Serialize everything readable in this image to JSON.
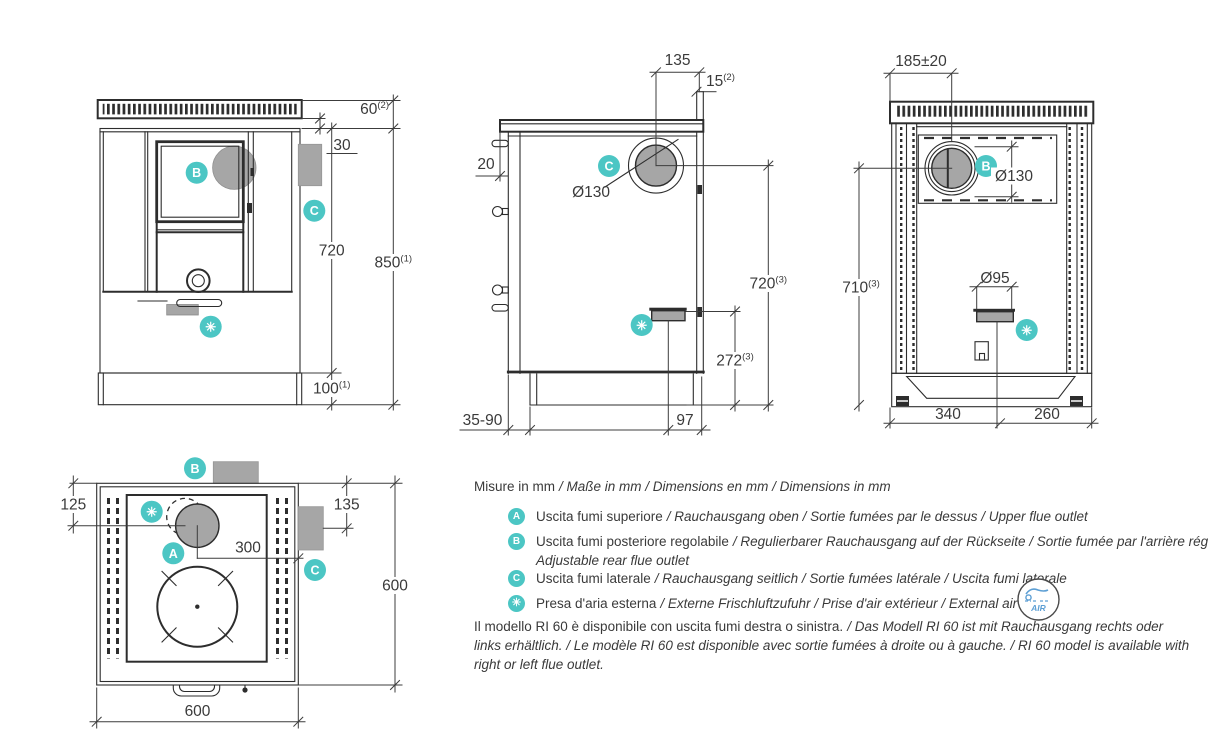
{
  "title": "RI 60 stove dimensional drawing",
  "colors": {
    "accent_teal": "#4cc6c4",
    "gray_fill": "#a6a6a6",
    "line": "#2d2d2d",
    "text": "#3a3a3a",
    "air_blue": "#5d9fd4"
  },
  "badges": {
    "a": "A",
    "b": "B",
    "c": "C",
    "star": "✳"
  },
  "dims": {
    "front": {
      "h60": "60",
      "h60_sup": "(2)",
      "h30": "30",
      "h720": "720",
      "h850": "850",
      "h850_sup": "(1)",
      "h100": "100",
      "h100_sup": "(1)"
    },
    "side": {
      "w135": "135",
      "w15": "15",
      "w15_sup": "(2)",
      "w20": "20",
      "d130": "Ø130",
      "h720": "720",
      "h720_sup": "(3)",
      "h272": "272",
      "h272_sup": "(3)",
      "w3590": "35-90",
      "w97": "97"
    },
    "rear": {
      "w185": "185±20",
      "d130": "Ø130",
      "h710": "710",
      "h710_sup": "(3)",
      "d95": "Ø95",
      "w340": "340",
      "w260": "260"
    },
    "top": {
      "d125": "125",
      "d300": "300",
      "d135": "135",
      "d600_right": "600",
      "d600_bottom": "600"
    }
  },
  "legend": {
    "units": {
      "primary": "Misure in mm",
      "secondary": "/ Maße in mm / Dimensions en mm / Dimensions in mm"
    },
    "items": [
      {
        "badge": "A",
        "primary": "Uscita fumi superiore",
        "secondary": "/ Rauchausgang oben  / Sortie fumées par le dessus / Upper flue outlet"
      },
      {
        "badge": "B",
        "primary": "Uscita fumi posteriore regolabile",
        "secondary": "/  Regulierbarer Rauchausgang auf der Rückseite / Sortie fumée par l'arrière réglable /",
        "secondary2": "Adjustable rear flue outlet"
      },
      {
        "badge": "C",
        "primary": "Uscita fumi laterale",
        "secondary": "/ Rauchausgang seitlich  / Sortie fumées latérale / Uscita fumi laterale"
      },
      {
        "badge": "✳",
        "primary": "Presa d'aria esterna",
        "secondary": "/ Externe Frischluftzufuhr / Prise d'air extérieur / External air inlet"
      }
    ],
    "air_icon_label": "AIR",
    "note": {
      "primary": "Il modello RI 60 è disponibile con uscita fumi destra o sinistra.",
      "secondary": "/ Das Modell RI 60 ist mit Rauchausgang rechts oder links erhältlich. / Le modèle RI 60 est disponible avec sortie fumées à droite ou à gauche. / RI 60 model is available with right or left flue outlet."
    }
  }
}
